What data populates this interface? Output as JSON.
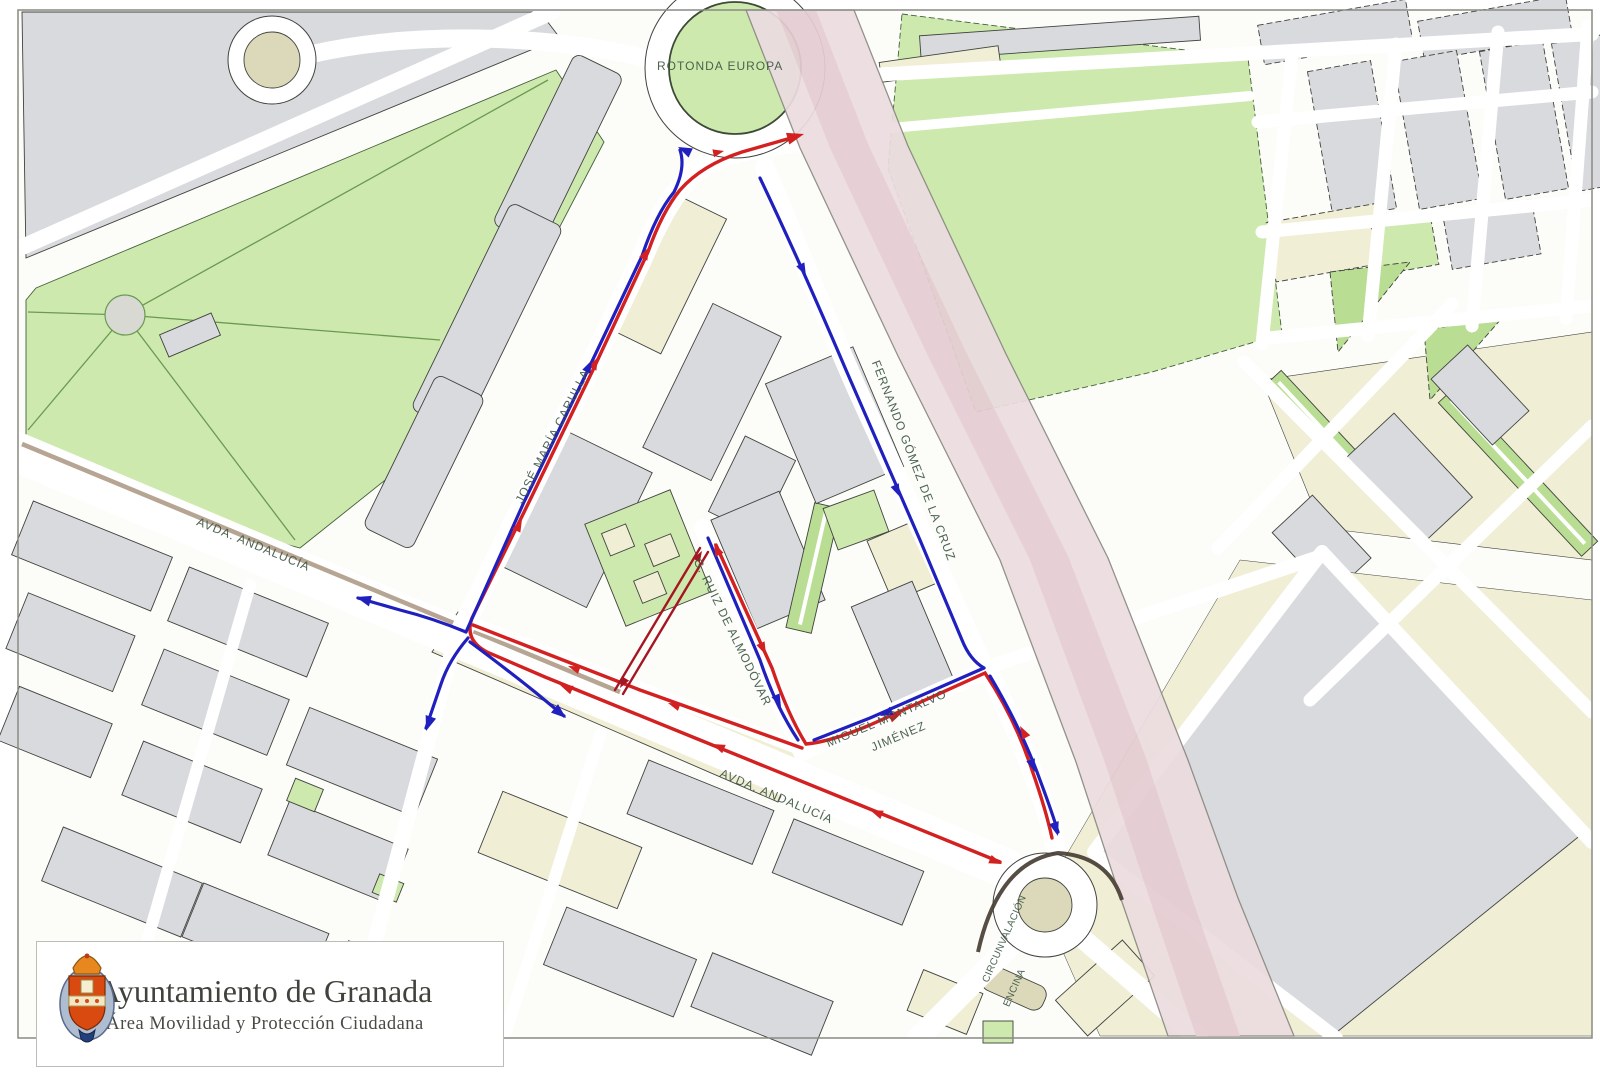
{
  "map": {
    "labels": {
      "roundabout_europa": "ROTONDA EUROPA",
      "street_jose_maria": "JOSÉ MARÍA CARULLA",
      "street_fernando": "FERNANDO GÓMEZ DE LA CRUZ",
      "avenue_andalucia_left": "AVDA. ANDALUCÍA",
      "avenue_andalucia_bottom": "AVDA. ANDALUCÍA",
      "street_ruiz_almodovar": "G. RUIZ DE ALMODÓVAR",
      "street_miguel_line1": "MIGUEL MONTALVO",
      "street_miguel_line2": "JIMÉNEZ",
      "ring_road": "CIRCUNVALACIÓN",
      "street_encina": "ENCINA"
    },
    "palette": {
      "street": "#ffffff",
      "outline": "#41433f",
      "block-gray": "#d8dade",
      "block-cream": "#f1eed6",
      "block-green": "#cde9ad",
      "block-green2": "#b9dd92",
      "block-olive": "#dcd9ba",
      "park-line": "#6a9a52",
      "band": "#ecdce0",
      "band-inner": "#e5cdd3",
      "median": "#b7a593",
      "label": "#3e5744",
      "route-red": "#d32020",
      "route-red-dark": "#a51623",
      "route-blue": "#2020be"
    }
  },
  "logo": {
    "title": "Ayuntamiento de Granada",
    "subtitle": "Área Movilidad y Protección Ciudadana"
  }
}
